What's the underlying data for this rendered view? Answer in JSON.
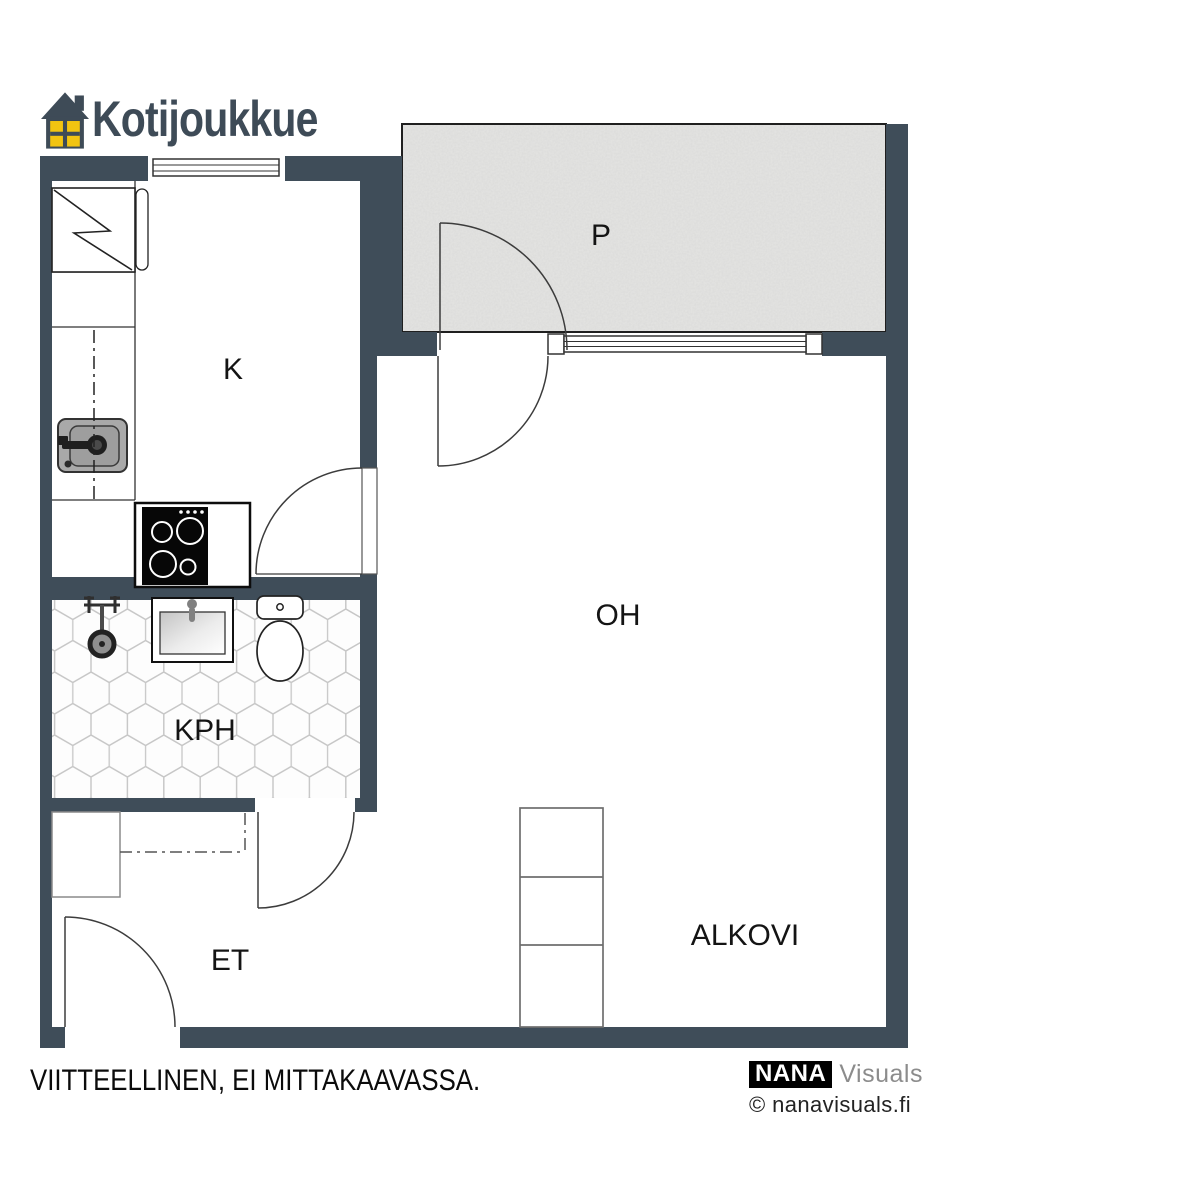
{
  "brand": {
    "name": "Kotijoukkue"
  },
  "plan": {
    "rooms": [
      {
        "code": "P",
        "meaning": "balcony"
      },
      {
        "code": "K",
        "meaning": "kitchen"
      },
      {
        "code": "OH",
        "meaning": "living-room"
      },
      {
        "code": "KPH",
        "meaning": "bathroom"
      },
      {
        "code": "ET",
        "meaning": "entrance-hall"
      },
      {
        "code": "ALKOVI",
        "meaning": "alcove"
      }
    ]
  },
  "footer": {
    "disclaimer": "VIITTEELLINEN, EI MITTAKAAVASSA.",
    "credit_logo": "NANA",
    "credit_name": "Visuals",
    "credit_site": "© nanavisuals.fi"
  },
  "colors": {
    "wall": "#3f4d59",
    "brand_text": "#3e4b57",
    "logo_yellow": "#f2c411",
    "balcony_fill": "#e5e5e3"
  }
}
